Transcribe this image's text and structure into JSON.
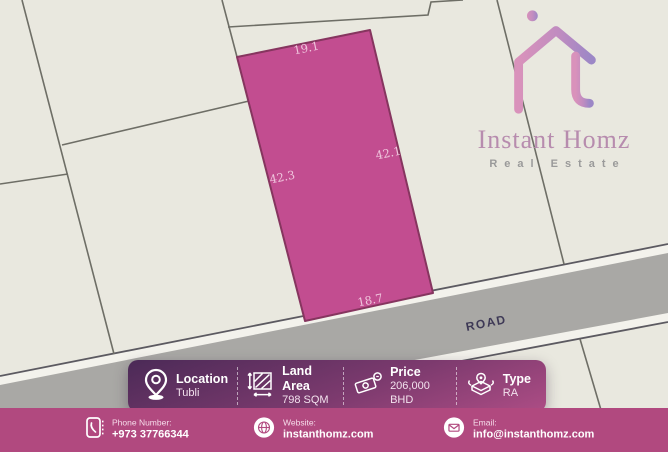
{
  "logo": {
    "name": "Instant Homz",
    "tagline": "Real Estate"
  },
  "map": {
    "road_label": "ROAD",
    "plot": {
      "dim_top": "19.1",
      "dim_left": "42.3",
      "dim_right": "42.1",
      "dim_bottom": "18.7"
    }
  },
  "info_bar": {
    "items": [
      {
        "icon": "location-pin-icon",
        "label": "Location",
        "value": "Tubli"
      },
      {
        "icon": "area-icon",
        "label": "Land Area",
        "value": "798 SQM"
      },
      {
        "icon": "money-icon",
        "label": "Price",
        "value": "206,000 BHD"
      },
      {
        "icon": "map-type-icon",
        "label": "Type",
        "value": "RA"
      }
    ]
  },
  "footer": {
    "contacts": [
      {
        "icon": "phone-icon",
        "label": "Phone Number:",
        "value": "+973 37766344"
      },
      {
        "icon": "globe-icon",
        "label": "Website:",
        "value": "instanthomz.com"
      },
      {
        "icon": "email-icon",
        "label": "Email:",
        "value": "info@instanthomz.com"
      }
    ]
  },
  "colors": {
    "map_background": "#e9e8df",
    "parcel_line": "#6e6e66",
    "plot_fill": "#c24d90",
    "plot_stroke": "#86355f",
    "dim_label": "#efc6dd",
    "road_gray": "#a9a8a5",
    "road_edge": "#5c5a61",
    "road_text": "#3e3956",
    "bar_gradient_start": "#4b2a57",
    "bar_gradient_end": "#ad4d85",
    "footer_background": "#b1497f",
    "logo_pink": "#d992bb",
    "logo_purple": "#9c87c6"
  }
}
